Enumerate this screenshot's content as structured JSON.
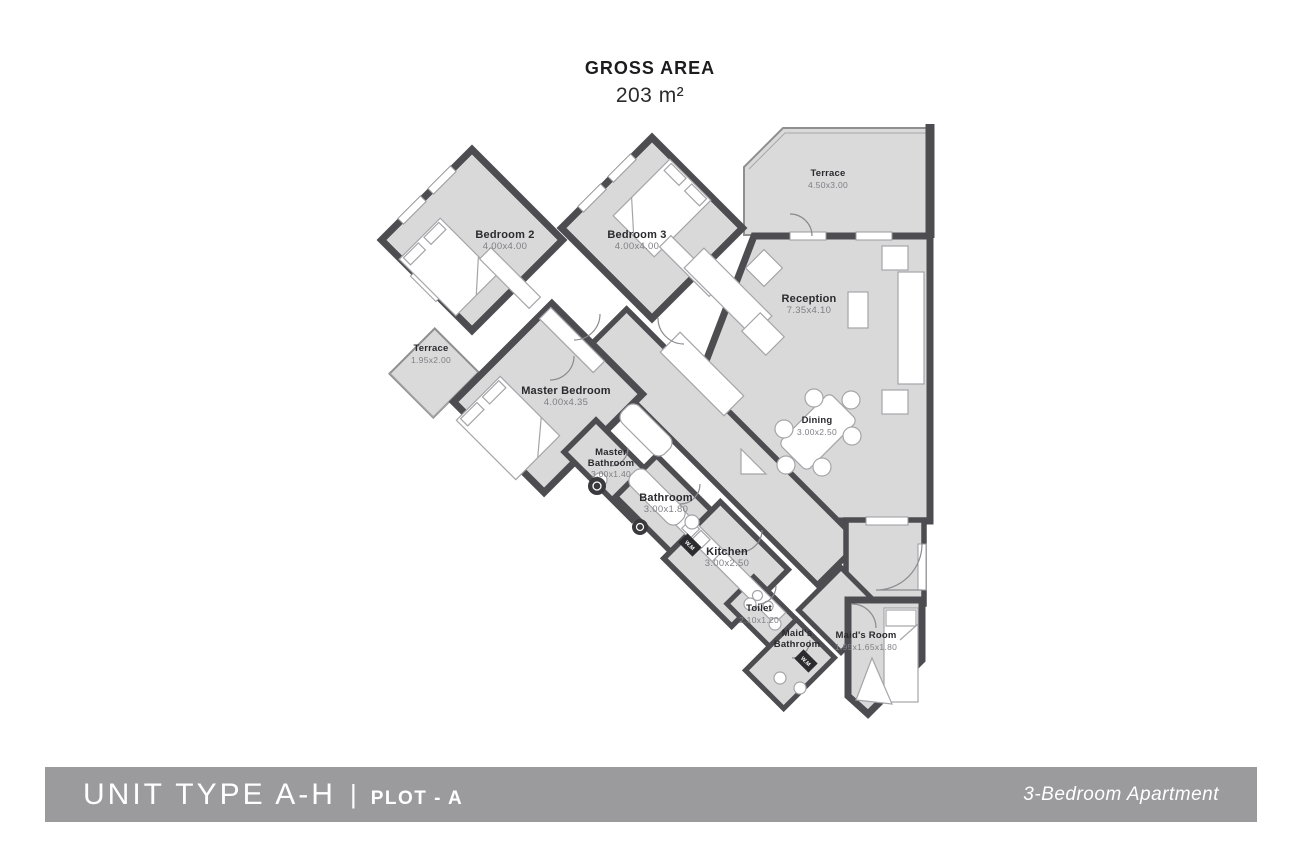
{
  "title": {
    "label": "GROSS AREA",
    "area": "203 m²"
  },
  "rooms": {
    "bedroom2": {
      "name": "Bedroom 2",
      "dims": "4.00x4.00"
    },
    "bedroom3": {
      "name": "Bedroom 3",
      "dims": "4.00x4.00"
    },
    "terrace_top": {
      "name": "Terrace",
      "dims": "4.50x3.00"
    },
    "reception": {
      "name": "Reception",
      "dims": "7.35x4.10"
    },
    "terrace_small": {
      "name": "Terrace",
      "dims": "1.95x2.00"
    },
    "master_bedroom": {
      "name": "Master Bedroom",
      "dims": "4.00x4.35"
    },
    "dining": {
      "name": "Dining",
      "dims": "3.00x2.50"
    },
    "master_bathroom": {
      "name": "Master Bathroom",
      "dims": "3.00x1.40"
    },
    "bathroom": {
      "name": "Bathroom",
      "dims": "3.00x1.80"
    },
    "kitchen": {
      "name": "Kitchen",
      "dims": "3.00x2.50"
    },
    "toilet": {
      "name": "Toilet",
      "dims": "2.10x1.20"
    },
    "maids_bathroom": {
      "name": "Maid's Bathroom",
      "dims": ""
    },
    "maids_room": {
      "name": "Maid's Room",
      "dims": "1.95x1.65x1.80"
    }
  },
  "badges": {
    "wm": "W.M"
  },
  "footer": {
    "unit_type": "UNIT TYPE A-H",
    "separator": "|",
    "plot": "PLOT - A",
    "apartment_type": "3-Bedroom Apartment"
  },
  "colors": {
    "wall": "#4d4d51",
    "floor": "#d9d9d9",
    "footer_bar": "#9b9a9c",
    "label_text": "#2a2a2e",
    "dim_text": "#7f7f85"
  }
}
